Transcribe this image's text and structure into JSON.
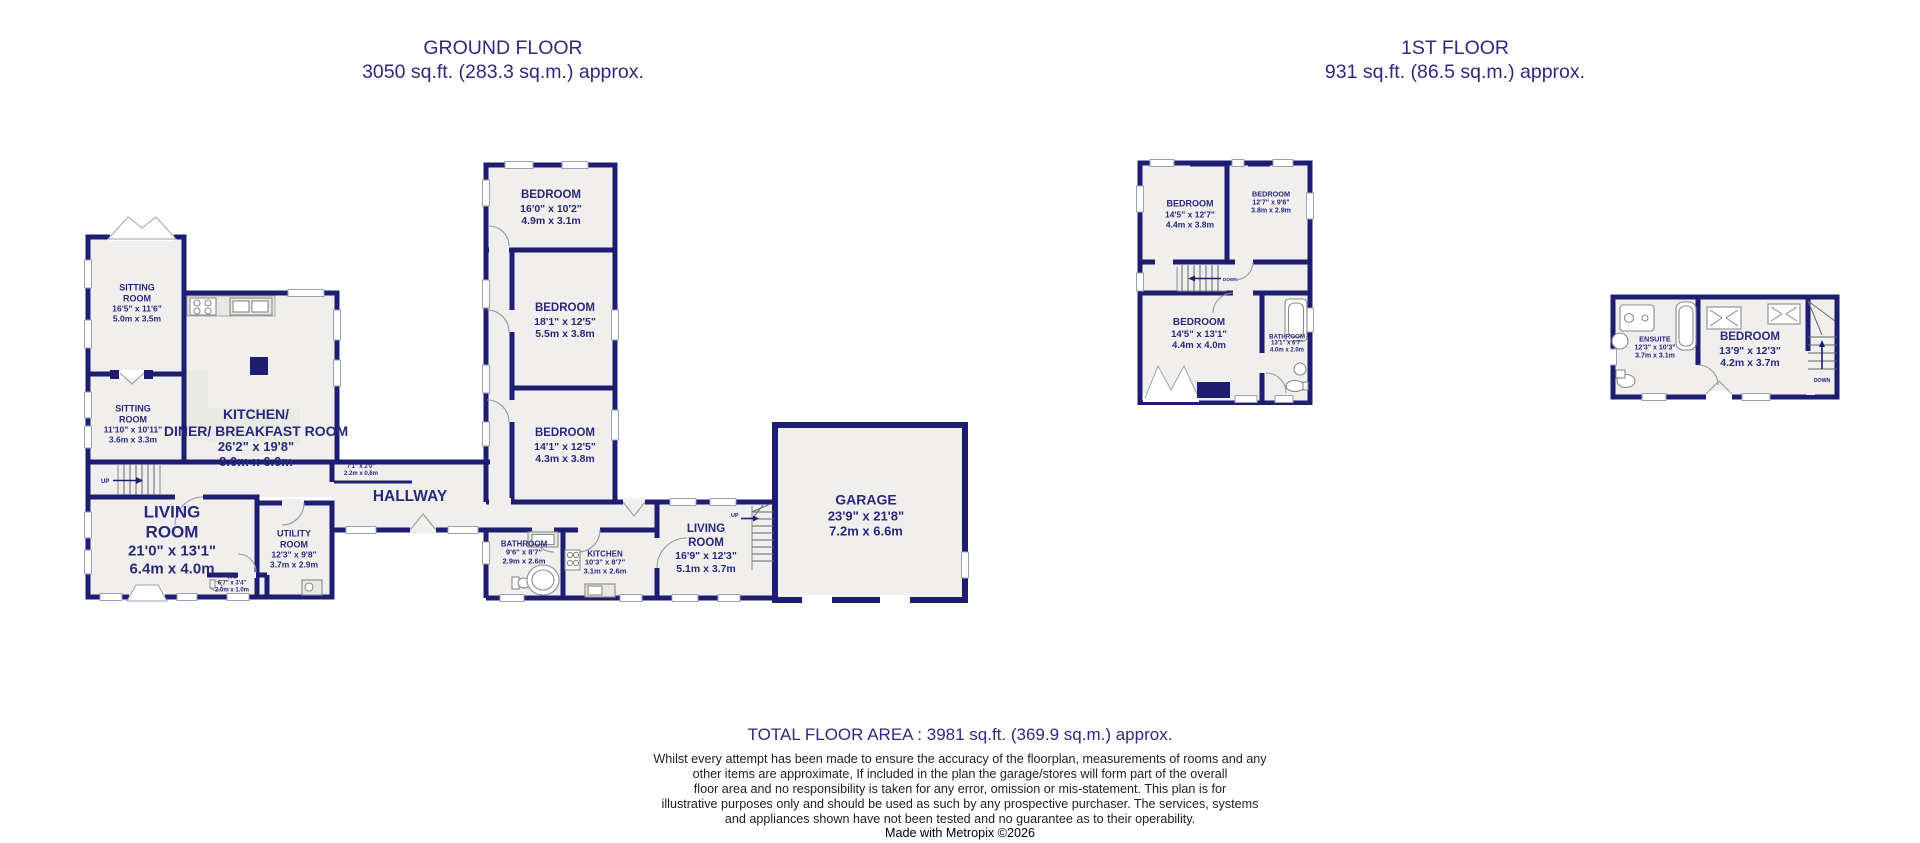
{
  "titles": {
    "ground": {
      "name": "GROUND FLOOR",
      "area": "3050 sq.ft. (283.3 sq.m.) approx."
    },
    "first": {
      "name": "1ST FLOOR",
      "area": "931 sq.ft. (86.5 sq.m.) approx."
    }
  },
  "labels": {
    "up": "UP",
    "down": "DOWN"
  },
  "rooms": {
    "sitting1": {
      "name": "SITTING\nROOM",
      "imp": "16'5\" x 11'6\"",
      "met": "5.0m x 3.5m"
    },
    "sitting2": {
      "name": "SITTING\nROOM",
      "imp": "11'10\" x 10'11\"",
      "met": "3.6m x 3.3m"
    },
    "kitchen_diner": {
      "name": "KITCHEN/\nDINER/ BREAKFAST ROOM",
      "imp": "26'2\" x 19'8\"",
      "met": "8.0m x 6.0m"
    },
    "hallway": {
      "name": "HALLWAY"
    },
    "cupboard": {
      "imp": "7'1\" x 2'0\"",
      "met": "2.2m x 0.6m"
    },
    "living1": {
      "name": "LIVING\nROOM",
      "imp": "21'0\" x 13'1\"",
      "met": "6.4m x 4.0m"
    },
    "utility": {
      "name": "UTILITY\nROOM",
      "imp": "12'3\" x 9'8\"",
      "met": "3.7m x 2.9m"
    },
    "wc": {
      "name": "WC",
      "imp": "6'7\" x 3'4\"",
      "met": "2.0m x 1.0m"
    },
    "bed1": {
      "name": "BEDROOM",
      "imp": "16'0\" x 10'2\"",
      "met": "4.9m x 3.1m"
    },
    "bed2": {
      "name": "BEDROOM",
      "imp": "18'1\" x 12'5\"",
      "met": "5.5m x 3.8m"
    },
    "bed3": {
      "name": "BEDROOM",
      "imp": "14'1\" x 12'5\"",
      "met": "4.3m x 3.8m"
    },
    "bathroom_g": {
      "name": "BATHROOM",
      "imp": "9'6\" x 8'7\"",
      "met": "2.9m x 2.6m"
    },
    "kitchen2": {
      "name": "KITCHEN",
      "imp": "10'3\" x 8'7\"",
      "met": "3.1m x 2.6m"
    },
    "living2": {
      "name": "LIVING\nROOM",
      "imp": "16'9\" x 12'3\"",
      "met": "5.1m x 3.7m"
    },
    "garage": {
      "name": "GARAGE",
      "imp": "23'9\" x 21'8\"",
      "met": "7.2m x 6.6m"
    },
    "f_bed_tl": {
      "name": "BEDROOM",
      "imp": "14'5\" x 12'7\"",
      "met": "4.4m x 3.8m"
    },
    "f_bed_tr": {
      "name": "BEDROOM",
      "imp": "12'7\" x 9'6\"",
      "met": "3.8m x 2.9m"
    },
    "f_bed_b": {
      "name": "BEDROOM",
      "imp": "14'5\" x 13'1\"",
      "met": "4.4m x 4.0m"
    },
    "f_bath": {
      "name": "BATHROOM",
      "imp": "13'1\" x 6'7\"",
      "met": "4.0m x 2.0m"
    },
    "ensuite": {
      "name": "ENSUITE",
      "imp": "12'3\" x 10'3\"",
      "met": "3.7m x 3.1m"
    },
    "a_bed": {
      "name": "BEDROOM",
      "imp": "13'9\" x 12'3\"",
      "met": "4.2m x 3.7m"
    }
  },
  "footer": {
    "total": "TOTAL FLOOR AREA : 3981 sq.ft. (369.9 sq.m.) approx.",
    "disclaimer": [
      "Whilst every attempt has been made to ensure the accuracy of the floorplan, measurements of rooms and any",
      "other items are approximate, If included in the plan the garage/stores will form part of the overall",
      "floor area and no responsibility is taken for any error, omission or mis-statement. This plan is for",
      "illustrative purposes only and should be used as such by any prospective purchaser. The services, systems",
      "and appliances shown have not been tested and no guarantee as to their operability."
    ],
    "credit": "Made with Metropix ©2026"
  },
  "colors": {
    "wall": "#1d1d71",
    "room_text": "#29297b",
    "floor": "#f0efed"
  }
}
